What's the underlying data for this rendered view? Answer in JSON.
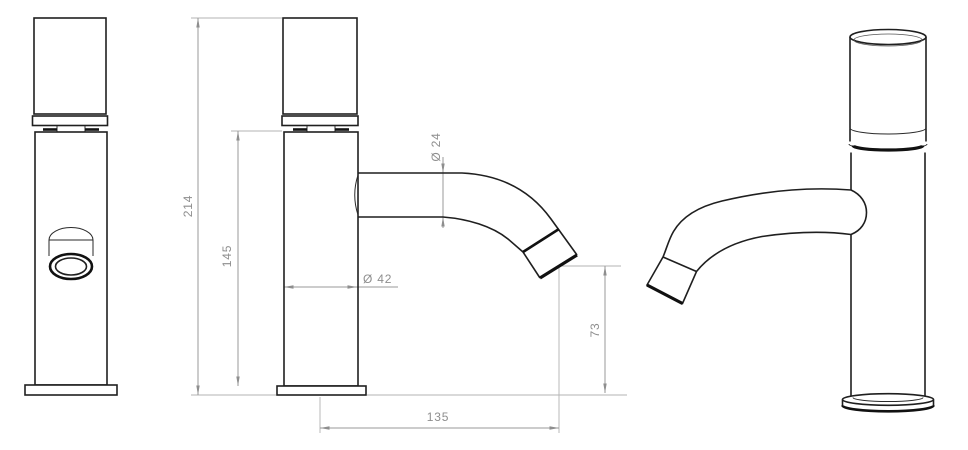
{
  "drawing": {
    "subject": "basin faucet technical drawing, three views",
    "views": [
      "front",
      "side-dimensioned",
      "perspective"
    ],
    "dimensions": {
      "total_height": "214",
      "body_height": "145",
      "spout_diameter": "Ø 24",
      "body_diameter": "Ø 42",
      "outlet_height": "73",
      "spout_reach": "135"
    },
    "colors": {
      "outline": "#1f1f1f",
      "dimension_line": "#9a9a9a",
      "dimension_text": "#8e8e8e",
      "background": "#ffffff"
    }
  }
}
